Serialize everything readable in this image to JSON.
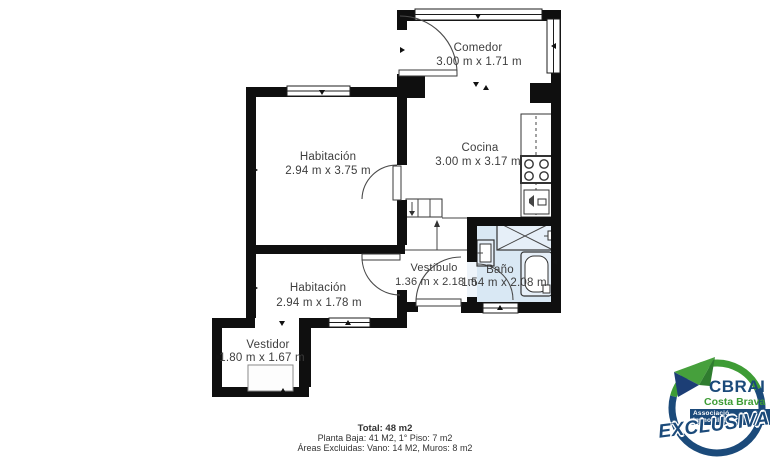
{
  "plan": {
    "rooms": [
      {
        "name": "Comedor",
        "dims": "3.00 m x 1.71 m"
      },
      {
        "name": "Cocina",
        "dims": "3.00 m x 3.17 m"
      },
      {
        "name": "Habitación",
        "dims": "2.94 m x 3.75 m"
      },
      {
        "name": "Habitación",
        "dims": "2.94 m x 1.78 m"
      },
      {
        "name": "Vestíbulo",
        "dims": "1.36 m x 2.18 m"
      },
      {
        "name": "Baño",
        "dims": "1.54 m x 2.08 m"
      },
      {
        "name": "Vestidor",
        "dims": "1.80 m x 1.67 m"
      }
    ],
    "colors": {
      "wall": "#0f0f0f",
      "bath_fill": "#d9e8f4",
      "text": "#3d3d3d"
    }
  },
  "summary": {
    "total": "Total: 48 m2",
    "line2": "Planta Baja: 41 M2, 1° Piso: 7 m2",
    "line3": "Áreas Excluidas: Vano: 14 M2, Muros: 8 m2"
  },
  "logo": {
    "brand": "CBRAI",
    "region": "Costa Brava",
    "association": "Associació Immobiliària",
    "badge": "EXCLUSIVA",
    "colors": {
      "green": "#3e9c35",
      "blue": "#1b4a7a"
    }
  }
}
